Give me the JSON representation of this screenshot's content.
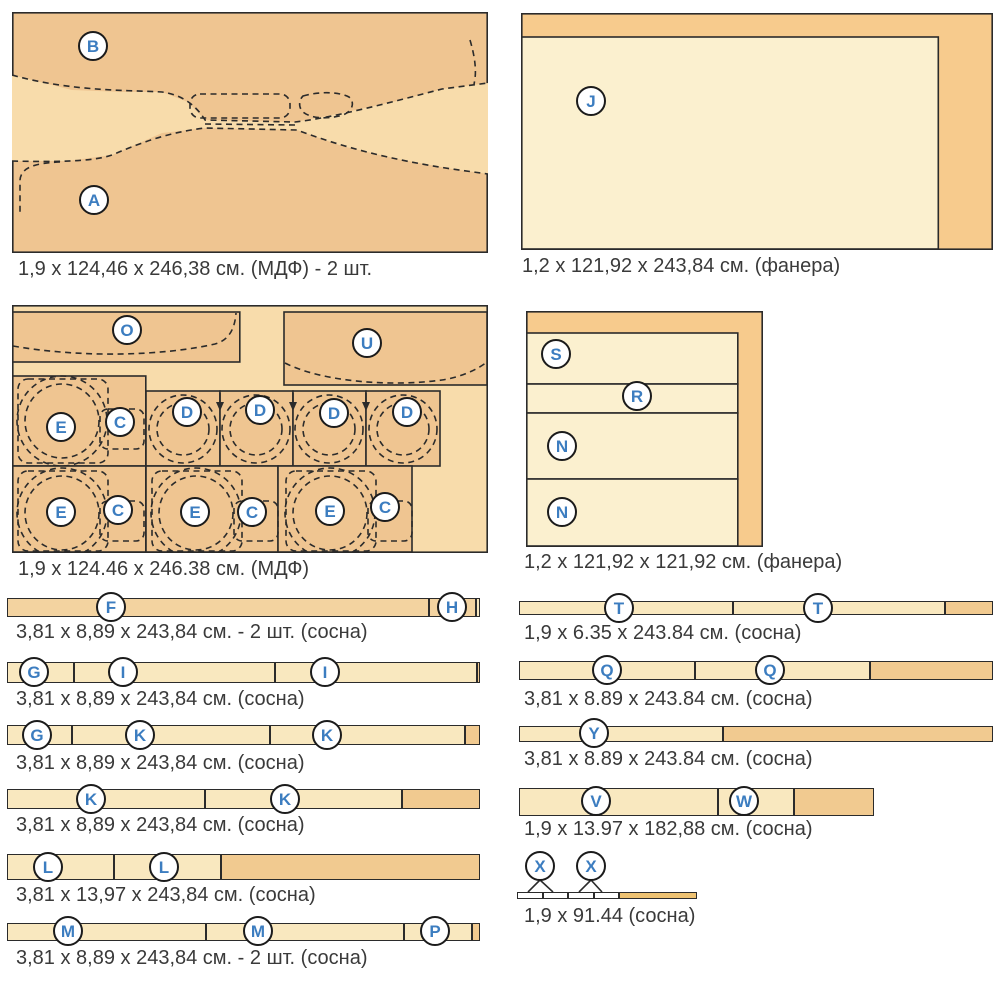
{
  "colors": {
    "tan_dark": "#efc591",
    "tan_light": "#f8dcab",
    "orange_frame": "#f7cb8d",
    "cream": "#fbf0cf",
    "strip_cream": "#f9e8bf",
    "strip_tan": "#f3d3a0",
    "offcut_tan": "#f1ca90",
    "gold": "#eec272",
    "label_blue": "#3c7dc0",
    "line_dark": "#2b2b2b",
    "text": "#3a3a3a"
  },
  "sheets": {
    "mdf1": {
      "caption": "1,9 x 124,46 x 246,38 см. (МДФ) - 2 шт.",
      "labels": {
        "A": "A",
        "B": "B"
      }
    },
    "plywood1": {
      "caption": "1,2 x 121,92 x 243,84 см. (фанера)",
      "labels": {
        "J": "J"
      }
    },
    "mdf2": {
      "caption": "1,9 x 124.46 x 246.38 см. (МДФ)",
      "labels": {
        "O": "O",
        "U": "U",
        "C": "C",
        "D": "D",
        "E": "E"
      }
    },
    "plywood2": {
      "caption": "1,2 x 121,92 x 121,92 см. (фанера)",
      "labels": {
        "S": "S",
        "R": "R",
        "N": "N"
      }
    }
  },
  "strips": {
    "fh": {
      "caption": "3,81 x 8,89 x 243,84 см. - 2 шт. (сосна)",
      "labels": {
        "F": "F",
        "H": "H"
      }
    },
    "gii": {
      "caption": "3,81 x 8,89 x 243,84 см. (сосна)",
      "labels": {
        "G": "G",
        "I": "I"
      }
    },
    "gkk": {
      "caption": "3,81 x 8,89 x 243,84 см. (сосна)",
      "labels": {
        "G": "G",
        "K": "K"
      }
    },
    "kk": {
      "caption": "3,81 x 8,89 x 243,84 см. (сосна)",
      "labels": {
        "K": "K"
      }
    },
    "ll": {
      "caption": "3,81 x 13,97 x 243,84 см. (сосна)",
      "labels": {
        "L": "L"
      }
    },
    "mmp": {
      "caption": "3,81 x 8,89 x 243,84 см. - 2 шт. (сосна)",
      "labels": {
        "M": "M",
        "P": "P"
      }
    },
    "tt": {
      "caption": "1,9 x 6.35 x 243.84 см. (сосна)",
      "labels": {
        "T": "T"
      }
    },
    "qq": {
      "caption": "3,81 x 8.89 x 243.84 см. (сосна)",
      "labels": {
        "Q": "Q"
      }
    },
    "y": {
      "caption": "3,81 x 8.89 x 243.84 см. (сосна)",
      "labels": {
        "Y": "Y"
      }
    },
    "vw": {
      "caption": "1,9 x 13.97 x 182,88 см. (сосна)",
      "labels": {
        "V": "V",
        "W": "W"
      }
    },
    "xx": {
      "caption": "1,9 x 91.44 (сосна)",
      "labels": {
        "X": "X"
      }
    }
  }
}
